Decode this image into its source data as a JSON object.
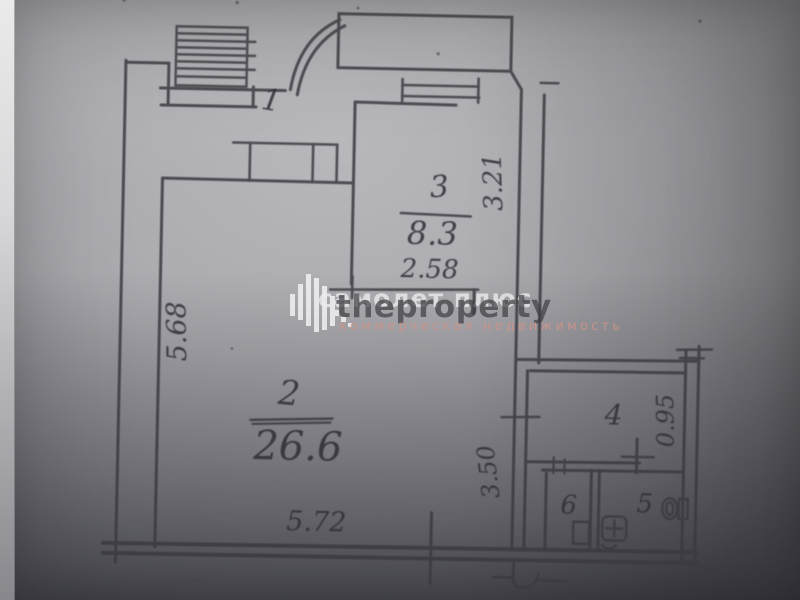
{
  "watermark": {
    "brand_back": "самолет плюс",
    "brand_front": "theproperty",
    "subtitle": "коммерческая недвижимость"
  },
  "floorplan": {
    "rooms": [
      {
        "number": "1"
      },
      {
        "number": "2",
        "area": "26.6"
      },
      {
        "number": "3",
        "area": "8.3"
      },
      {
        "number": "4"
      },
      {
        "number": "5"
      },
      {
        "number": "6"
      }
    ],
    "dimensions": {
      "left_height": "5.68",
      "room3_height": "3.21",
      "room3_width": "2.58",
      "hall_height": "3.50",
      "hall_width": "0.95",
      "bottom_width": "5.72"
    },
    "fixtures": [
      "stairs-hatch-icon",
      "toilet-icon",
      "sink-icon",
      "samolet-logo-icon"
    ]
  },
  "colors": {
    "paper": "#a9a9ae",
    "ink": "#3a3a40",
    "watermark_front": "#46464c",
    "watermark_back": "#e8e8ec",
    "watermark_subtitle": "#ce948a"
  }
}
